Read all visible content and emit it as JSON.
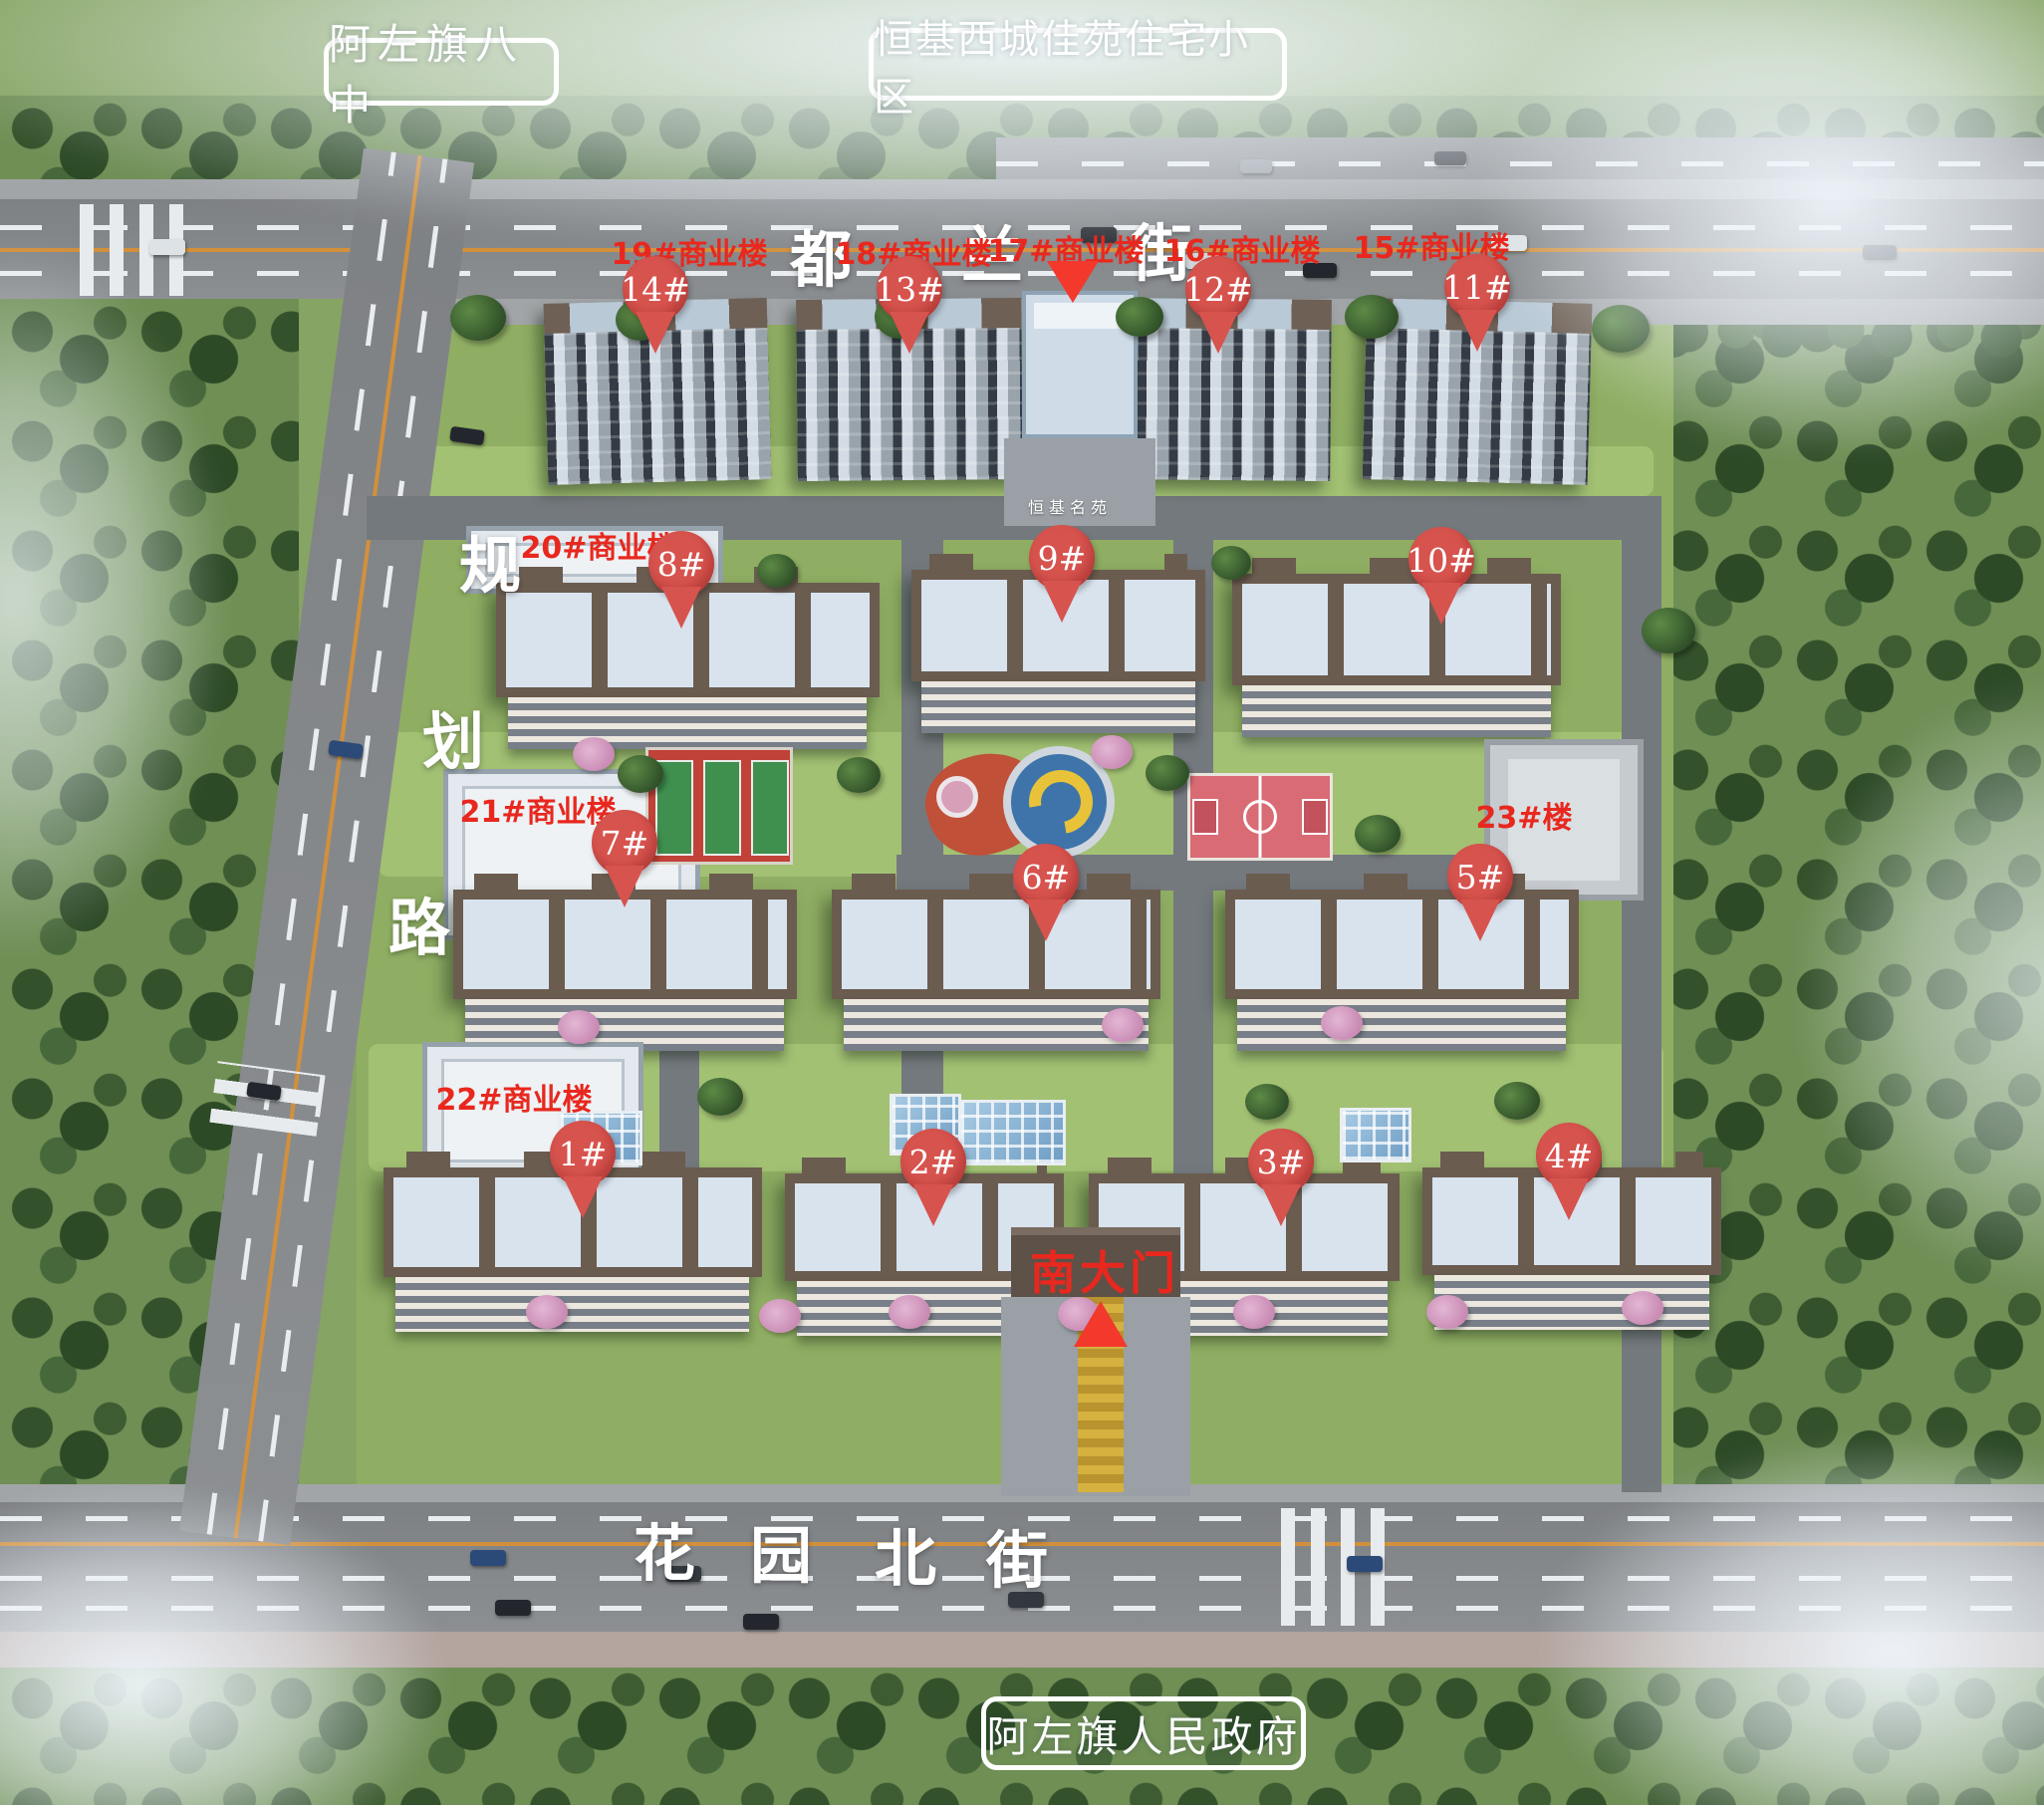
{
  "title": "恒基西城佳苑住宅小区",
  "landmarks": {
    "school": "阿左旗八中",
    "government": "阿左旗人民政府"
  },
  "streets": {
    "top": {
      "name": "都兰街",
      "chars": [
        "都",
        "兰",
        "街"
      ]
    },
    "left": {
      "name": "规划路",
      "chars": [
        "规",
        "划",
        "路"
      ]
    },
    "bottom": {
      "name": "花园北街",
      "chars": [
        "花",
        "园",
        "北",
        "街"
      ]
    }
  },
  "gates": {
    "south_label": "南大门",
    "entrance_sign": "恒基名苑"
  },
  "residential_pins": [
    {
      "label": "14#"
    },
    {
      "label": "13#"
    },
    {
      "label": "12#"
    },
    {
      "label": "11#"
    },
    {
      "label": "8#"
    },
    {
      "label": "9#"
    },
    {
      "label": "10#"
    },
    {
      "label": "7#"
    },
    {
      "label": "6#"
    },
    {
      "label": "5#"
    },
    {
      "label": "1#"
    },
    {
      "label": "2#"
    },
    {
      "label": "3#"
    },
    {
      "label": "4#"
    }
  ],
  "commercial_labels": [
    {
      "label": "19#商业楼"
    },
    {
      "label": "18#商业楼"
    },
    {
      "label": "17#商业楼"
    },
    {
      "label": "16#商业楼"
    },
    {
      "label": "15#商业楼"
    },
    {
      "label": "20#商业楼"
    },
    {
      "label": "21#商业楼"
    },
    {
      "label": "23#楼"
    },
    {
      "label": "22#商业楼"
    }
  ],
  "colors": {
    "pin_red": "#d7534e",
    "label_red": "#e8281e",
    "marker_red": "#f3392c",
    "street_text": "#ffffff"
  }
}
